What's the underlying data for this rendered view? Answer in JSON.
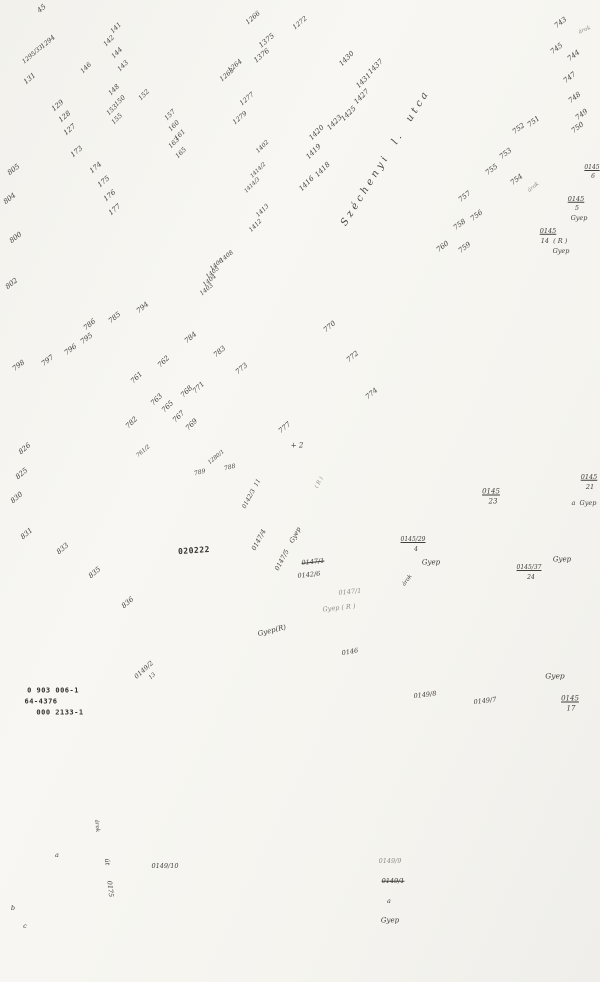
{
  "map": {
    "type": "cadastral-survey-sheet",
    "street_name": "Széchenyi  l.  utca",
    "land_use_term": "Gyep",
    "highlighted_parcel": "0147/5",
    "stamp_numbers": [
      "0 903 006-1",
      "64-4376",
      "000 2133-1",
      "020222"
    ]
  },
  "labels": [
    {
      "t": "45",
      "x": 42,
      "y": 9,
      "r": -40,
      "s": 7
    },
    {
      "t": "1294",
      "x": 48,
      "y": 42,
      "r": -40,
      "s": 6.5
    },
    {
      "t": "1295/33",
      "x": 33,
      "y": 55,
      "r": -40,
      "s": 6
    },
    {
      "t": "131",
      "x": 30,
      "y": 79,
      "r": -40,
      "s": 7
    },
    {
      "t": "129",
      "x": 58,
      "y": 106,
      "r": -40,
      "s": 7
    },
    {
      "t": "128",
      "x": 65,
      "y": 117,
      "r": -40,
      "s": 7
    },
    {
      "t": "127",
      "x": 70,
      "y": 130,
      "r": -40,
      "s": 7
    },
    {
      "t": "173",
      "x": 77,
      "y": 152,
      "r": -40,
      "s": 7
    },
    {
      "t": "174",
      "x": 96,
      "y": 168,
      "r": -40,
      "s": 7
    },
    {
      "t": "175",
      "x": 104,
      "y": 182,
      "r": -40,
      "s": 7
    },
    {
      "t": "176",
      "x": 110,
      "y": 196,
      "r": -40,
      "s": 7
    },
    {
      "t": "177",
      "x": 115,
      "y": 210,
      "r": -40,
      "s": 7
    },
    {
      "t": "141",
      "x": 116,
      "y": 28,
      "r": -45,
      "s": 6.5
    },
    {
      "t": "142",
      "x": 109,
      "y": 41,
      "r": -45,
      "s": 6.5
    },
    {
      "t": "144",
      "x": 117,
      "y": 53,
      "r": -45,
      "s": 6.5
    },
    {
      "t": "143",
      "x": 123,
      "y": 66,
      "r": -45,
      "s": 6.5
    },
    {
      "t": "146",
      "x": 86,
      "y": 68,
      "r": -45,
      "s": 6.5
    },
    {
      "t": "148",
      "x": 114,
      "y": 90,
      "r": -45,
      "s": 6.5
    },
    {
      "t": "150",
      "x": 120,
      "y": 101,
      "r": -45,
      "s": 6.5
    },
    {
      "t": "153",
      "x": 112,
      "y": 110,
      "r": -45,
      "s": 6.5
    },
    {
      "t": "155",
      "x": 117,
      "y": 119,
      "r": -45,
      "s": 6.5
    },
    {
      "t": "152",
      "x": 144,
      "y": 95,
      "r": -45,
      "s": 6.5
    },
    {
      "t": "157",
      "x": 170,
      "y": 115,
      "r": -45,
      "s": 6.5
    },
    {
      "t": "160",
      "x": 174,
      "y": 126,
      "r": -45,
      "s": 6.5
    },
    {
      "t": "161",
      "x": 180,
      "y": 135,
      "r": -45,
      "s": 6.5
    },
    {
      "t": "163",
      "x": 174,
      "y": 143,
      "r": -45,
      "s": 6.5
    },
    {
      "t": "165",
      "x": 181,
      "y": 153,
      "r": -45,
      "s": 6.5
    },
    {
      "t": "1266",
      "x": 253,
      "y": 18,
      "r": -40,
      "s": 6.5
    },
    {
      "t": "1272",
      "x": 300,
      "y": 23,
      "r": -40,
      "s": 6.5
    },
    {
      "t": "1375",
      "x": 267,
      "y": 41,
      "r": -40,
      "s": 7
    },
    {
      "t": "1376",
      "x": 262,
      "y": 56,
      "r": -40,
      "s": 7
    },
    {
      "t": "1264",
      "x": 235,
      "y": 66,
      "r": -40,
      "s": 6.5
    },
    {
      "t": "1263",
      "x": 227,
      "y": 75,
      "r": -40,
      "s": 6.5
    },
    {
      "t": "1277",
      "x": 247,
      "y": 99,
      "r": -40,
      "s": 6.5
    },
    {
      "t": "1279",
      "x": 240,
      "y": 118,
      "r": -40,
      "s": 6.5
    },
    {
      "t": "1430",
      "x": 347,
      "y": 59,
      "r": -45,
      "s": 7
    },
    {
      "t": "1437",
      "x": 376,
      "y": 67,
      "r": -45,
      "s": 7
    },
    {
      "t": "1431",
      "x": 364,
      "y": 81,
      "r": -45,
      "s": 7
    },
    {
      "t": "1427",
      "x": 362,
      "y": 97,
      "r": -45,
      "s": 7
    },
    {
      "t": "1425",
      "x": 349,
      "y": 114,
      "r": -45,
      "s": 7
    },
    {
      "t": "1423",
      "x": 335,
      "y": 123,
      "r": -45,
      "s": 7
    },
    {
      "t": "1420",
      "x": 317,
      "y": 133,
      "r": -45,
      "s": 7
    },
    {
      "t": "1419",
      "x": 314,
      "y": 152,
      "r": -45,
      "s": 7
    },
    {
      "t": "1418",
      "x": 323,
      "y": 170,
      "r": -45,
      "s": 7
    },
    {
      "t": "1416",
      "x": 307,
      "y": 184,
      "r": -45,
      "s": 7
    },
    {
      "t": "1402",
      "x": 263,
      "y": 147,
      "r": -45,
      "s": 6
    },
    {
      "t": "1414/2",
      "x": 259,
      "y": 171,
      "r": -45,
      "s": 5.5
    },
    {
      "t": "1414/3",
      "x": 253,
      "y": 186,
      "r": -45,
      "s": 5.5
    },
    {
      "t": "1413",
      "x": 263,
      "y": 211,
      "r": -45,
      "s": 6
    },
    {
      "t": "1412",
      "x": 256,
      "y": 226,
      "r": -45,
      "s": 6
    },
    {
      "t": "1408",
      "x": 227,
      "y": 257,
      "r": -40,
      "s": 6
    },
    {
      "t": "1406",
      "x": 217,
      "y": 265,
      "r": -40,
      "s": 6
    },
    {
      "t": "1405",
      "x": 213,
      "y": 273,
      "r": -40,
      "s": 6
    },
    {
      "t": "1404",
      "x": 210,
      "y": 281,
      "r": -40,
      "s": 6
    },
    {
      "t": "1403",
      "x": 207,
      "y": 290,
      "r": -40,
      "s": 6
    },
    {
      "t": "743",
      "x": 561,
      "y": 23,
      "r": -38,
      "s": 7
    },
    {
      "t": "745",
      "x": 557,
      "y": 49,
      "r": -38,
      "s": 7
    },
    {
      "t": "744",
      "x": 574,
      "y": 56,
      "r": -38,
      "s": 7
    },
    {
      "t": "747",
      "x": 570,
      "y": 78,
      "r": -38,
      "s": 7
    },
    {
      "t": "748",
      "x": 575,
      "y": 98,
      "r": -38,
      "s": 7
    },
    {
      "t": "749",
      "x": 582,
      "y": 115,
      "r": -38,
      "s": 7
    },
    {
      "t": "750",
      "x": 578,
      "y": 128,
      "r": -38,
      "s": 7
    },
    {
      "t": "751",
      "x": 534,
      "y": 122,
      "r": -38,
      "s": 7
    },
    {
      "t": "752",
      "x": 519,
      "y": 129,
      "r": -38,
      "s": 7
    },
    {
      "t": "753",
      "x": 506,
      "y": 154,
      "r": -38,
      "s": 7
    },
    {
      "t": "755",
      "x": 492,
      "y": 170,
      "r": -38,
      "s": 7
    },
    {
      "t": "754",
      "x": 517,
      "y": 180,
      "r": -38,
      "s": 7
    },
    {
      "t": "árok",
      "x": 534,
      "y": 188,
      "r": -38,
      "s": 5.5,
      "c": "f"
    },
    {
      "t": "757",
      "x": 465,
      "y": 197,
      "r": -38,
      "s": 7
    },
    {
      "t": "756",
      "x": 477,
      "y": 216,
      "r": -38,
      "s": 7
    },
    {
      "t": "758",
      "x": 460,
      "y": 225,
      "r": -38,
      "s": 7
    },
    {
      "t": "759",
      "x": 465,
      "y": 248,
      "r": -38,
      "s": 7
    },
    {
      "t": "760",
      "x": 443,
      "y": 247,
      "r": -38,
      "s": 7
    },
    {
      "t": "árok",
      "x": 585,
      "y": 31,
      "r": -22,
      "s": 5.5,
      "c": "f"
    },
    {
      "t": "770",
      "x": 330,
      "y": 327,
      "r": -40,
      "s": 7
    },
    {
      "t": "772",
      "x": 353,
      "y": 357,
      "r": -40,
      "s": 7
    },
    {
      "t": "774",
      "x": 372,
      "y": 394,
      "r": -40,
      "s": 7
    },
    {
      "t": "777",
      "x": 285,
      "y": 428,
      "r": -40,
      "s": 7
    },
    {
      "t": "784",
      "x": 191,
      "y": 338,
      "r": -40,
      "s": 7
    },
    {
      "t": "783",
      "x": 220,
      "y": 352,
      "r": -40,
      "s": 7
    },
    {
      "t": "773",
      "x": 242,
      "y": 369,
      "r": -40,
      "s": 7
    },
    {
      "t": "794",
      "x": 143,
      "y": 308,
      "r": -40,
      "s": 7
    },
    {
      "t": "785",
      "x": 115,
      "y": 318,
      "r": -40,
      "s": 7
    },
    {
      "t": "786",
      "x": 90,
      "y": 325,
      "r": -40,
      "s": 7
    },
    {
      "t": "761",
      "x": 137,
      "y": 378,
      "r": -45,
      "s": 7
    },
    {
      "t": "762",
      "x": 164,
      "y": 362,
      "r": -45,
      "s": 7
    },
    {
      "t": "763",
      "x": 157,
      "y": 400,
      "r": -45,
      "s": 7
    },
    {
      "t": "765",
      "x": 168,
      "y": 407,
      "r": -45,
      "s": 7
    },
    {
      "t": "767",
      "x": 179,
      "y": 417,
      "r": -45,
      "s": 7
    },
    {
      "t": "768",
      "x": 187,
      "y": 392,
      "r": -45,
      "s": 7
    },
    {
      "t": "769",
      "x": 192,
      "y": 425,
      "r": -45,
      "s": 7
    },
    {
      "t": "771",
      "x": 199,
      "y": 388,
      "r": -45,
      "s": 7
    },
    {
      "t": "782",
      "x": 132,
      "y": 423,
      "r": -45,
      "s": 7
    },
    {
      "t": "805",
      "x": 14,
      "y": 170,
      "r": -38,
      "s": 7
    },
    {
      "t": "804",
      "x": 10,
      "y": 199,
      "r": -38,
      "s": 7
    },
    {
      "t": "800",
      "x": 16,
      "y": 238,
      "r": -38,
      "s": 7
    },
    {
      "t": "802",
      "x": 12,
      "y": 284,
      "r": -38,
      "s": 7
    },
    {
      "t": "798",
      "x": 19,
      "y": 366,
      "r": -38,
      "s": 7
    },
    {
      "t": "797",
      "x": 48,
      "y": 361,
      "r": -38,
      "s": 7
    },
    {
      "t": "796",
      "x": 71,
      "y": 350,
      "r": -38,
      "s": 7
    },
    {
      "t": "795",
      "x": 87,
      "y": 339,
      "r": -38,
      "s": 7
    },
    {
      "t": "826",
      "x": 25,
      "y": 449,
      "r": -40,
      "s": 7
    },
    {
      "t": "825",
      "x": 22,
      "y": 474,
      "r": -40,
      "s": 7
    },
    {
      "t": "830",
      "x": 17,
      "y": 498,
      "r": -40,
      "s": 7
    },
    {
      "t": "831",
      "x": 27,
      "y": 534,
      "r": -40,
      "s": 7
    },
    {
      "t": "833",
      "x": 63,
      "y": 549,
      "r": -40,
      "s": 7
    },
    {
      "t": "835",
      "x": 95,
      "y": 573,
      "r": -40,
      "s": 7
    },
    {
      "t": "836",
      "x": 128,
      "y": 603,
      "r": -40,
      "s": 7
    },
    {
      "t": "1280/1",
      "x": 217,
      "y": 458,
      "r": -40,
      "s": 5.5
    },
    {
      "t": "788",
      "x": 230,
      "y": 468,
      "r": -14,
      "s": 6
    },
    {
      "t": "789",
      "x": 200,
      "y": 473,
      "r": -14,
      "s": 6
    },
    {
      "t": "761/2",
      "x": 144,
      "y": 452,
      "r": -40,
      "s": 5.5
    },
    {
      "t": "+ 2",
      "x": 297,
      "y": 446,
      "r": 0,
      "s": 7
    },
    {
      "t": "0142/3  11",
      "x": 252,
      "y": 494,
      "r": -62,
      "s": 6
    },
    {
      "t": "0147/4",
      "x": 259,
      "y": 540,
      "r": -62,
      "s": 6.5
    },
    {
      "t": "0147/5    Gyep",
      "x": 288,
      "y": 549,
      "r": -62,
      "s": 6.5
    },
    {
      "t": "( R )",
      "x": 320,
      "y": 483,
      "r": -62,
      "s": 5.5,
      "c": "f"
    },
    {
      "t": "0147/1",
      "x": 313,
      "y": 562,
      "r": -6,
      "s": 6.5,
      "c": "s"
    },
    {
      "t": "0142/6",
      "x": 309,
      "y": 575,
      "r": -6,
      "s": 6.5
    },
    {
      "t": "0147/1",
      "x": 350,
      "y": 592,
      "r": -6,
      "s": 6.5,
      "c": "f"
    },
    {
      "t": "Gyep ( R )",
      "x": 339,
      "y": 608,
      "r": -6,
      "s": 6.5,
      "c": "f"
    },
    {
      "t": "Gyep(R)",
      "x": 272,
      "y": 631,
      "r": -14,
      "s": 7
    },
    {
      "t": "020222",
      "x": 194,
      "y": 551,
      "r": -4,
      "s": 8,
      "c": "b"
    },
    {
      "t": "0 903 006-1",
      "x": 53,
      "y": 691,
      "r": 0,
      "s": 7,
      "c": "b"
    },
    {
      "t": "64-4376",
      "x": 41,
      "y": 702,
      "r": 0,
      "s": 7,
      "c": "b"
    },
    {
      "t": "000 2133-1",
      "x": 60,
      "y": 713,
      "r": 0,
      "s": 7,
      "c": "b"
    },
    {
      "t": "0145",
      "x": 491,
      "y": 492,
      "r": 0,
      "s": 7,
      "c": "u"
    },
    {
      "t": "23",
      "x": 493,
      "y": 502,
      "r": 0,
      "s": 7
    },
    {
      "t": "0145",
      "x": 589,
      "y": 477,
      "r": 0,
      "s": 6.5,
      "c": "u"
    },
    {
      "t": "21",
      "x": 590,
      "y": 487,
      "r": 0,
      "s": 6.5
    },
    {
      "t": "a  Gyep",
      "x": 584,
      "y": 503,
      "r": 0,
      "s": 6.5
    },
    {
      "t": "0145/29",
      "x": 413,
      "y": 540,
      "r": 0,
      "s": 6,
      "c": "u"
    },
    {
      "t": "4",
      "x": 416,
      "y": 550,
      "r": 0,
      "s": 6
    },
    {
      "t": "Gyep",
      "x": 431,
      "y": 563,
      "r": 0,
      "s": 7
    },
    {
      "t": "árok",
      "x": 408,
      "y": 581,
      "r": -52,
      "s": 5.5
    },
    {
      "t": "0145/37",
      "x": 529,
      "y": 568,
      "r": 0,
      "s": 6,
      "c": "u"
    },
    {
      "t": "24",
      "x": 531,
      "y": 578,
      "r": 0,
      "s": 6
    },
    {
      "t": "Gyep",
      "x": 562,
      "y": 560,
      "r": 0,
      "s": 7
    },
    {
      "t": "0145",
      "x": 576,
      "y": 199,
      "r": 0,
      "s": 6.5,
      "c": "u"
    },
    {
      "t": "5",
      "x": 577,
      "y": 208,
      "r": 0,
      "s": 6.5
    },
    {
      "t": "Gyep",
      "x": 579,
      "y": 218,
      "r": 0,
      "s": 6.5
    },
    {
      "t": "0145",
      "x": 548,
      "y": 231,
      "r": 0,
      "s": 6.5,
      "c": "u"
    },
    {
      "t": "14  ( R )",
      "x": 554,
      "y": 241,
      "r": 0,
      "s": 6.5
    },
    {
      "t": "Gyep",
      "x": 561,
      "y": 251,
      "r": 0,
      "s": 6.5
    },
    {
      "t": "0145",
      "x": 592,
      "y": 168,
      "r": 0,
      "s": 6,
      "c": "u"
    },
    {
      "t": "6",
      "x": 593,
      "y": 177,
      "r": 0,
      "s": 6
    },
    {
      "t": "0145",
      "x": 570,
      "y": 699,
      "r": 0,
      "s": 7,
      "c": "u"
    },
    {
      "t": "17",
      "x": 571,
      "y": 709,
      "r": 0,
      "s": 7
    },
    {
      "t": "Gyep",
      "x": 555,
      "y": 676,
      "r": 0,
      "s": 7.5
    },
    {
      "t": "0149/8",
      "x": 425,
      "y": 695,
      "r": -7,
      "s": 6.5
    },
    {
      "t": "0149/7",
      "x": 485,
      "y": 701,
      "r": -7,
      "s": 6.5
    },
    {
      "t": "0146",
      "x": 350,
      "y": 652,
      "r": -10,
      "s": 6.5
    },
    {
      "t": "0149/2",
      "x": 144,
      "y": 670,
      "r": -42,
      "s": 6.5
    },
    {
      "t": "13",
      "x": 153,
      "y": 677,
      "r": -42,
      "s": 5.5
    },
    {
      "t": "0149/10",
      "x": 165,
      "y": 866,
      "r": 0,
      "s": 6.5
    },
    {
      "t": "0149/9",
      "x": 390,
      "y": 861,
      "r": 0,
      "s": 6.5,
      "c": "f"
    },
    {
      "t": "0149/1",
      "x": 393,
      "y": 881,
      "r": 0,
      "s": 6.5,
      "c": "s"
    },
    {
      "t": "a",
      "x": 389,
      "y": 901,
      "r": 0,
      "s": 6.5
    },
    {
      "t": "Gyep",
      "x": 390,
      "y": 921,
      "r": 0,
      "s": 7
    },
    {
      "t": "árok",
      "x": 96,
      "y": 826,
      "r": 84,
      "s": 5.5
    },
    {
      "t": "út",
      "x": 107,
      "y": 862,
      "r": 84,
      "s": 6.5
    },
    {
      "t": "0175",
      "x": 110,
      "y": 889,
      "r": 84,
      "s": 6.5
    },
    {
      "t": "a",
      "x": 57,
      "y": 855,
      "r": 0,
      "s": 6.5
    },
    {
      "t": "b",
      "x": 13,
      "y": 908,
      "r": 0,
      "s": 6.5
    },
    {
      "t": "c",
      "x": 25,
      "y": 926,
      "r": 0,
      "s": 6.5
    },
    {
      "t": "Széchenyi  l.  utca",
      "x": 386,
      "y": 158,
      "r": -58,
      "s": 10,
      "c": "street"
    }
  ]
}
